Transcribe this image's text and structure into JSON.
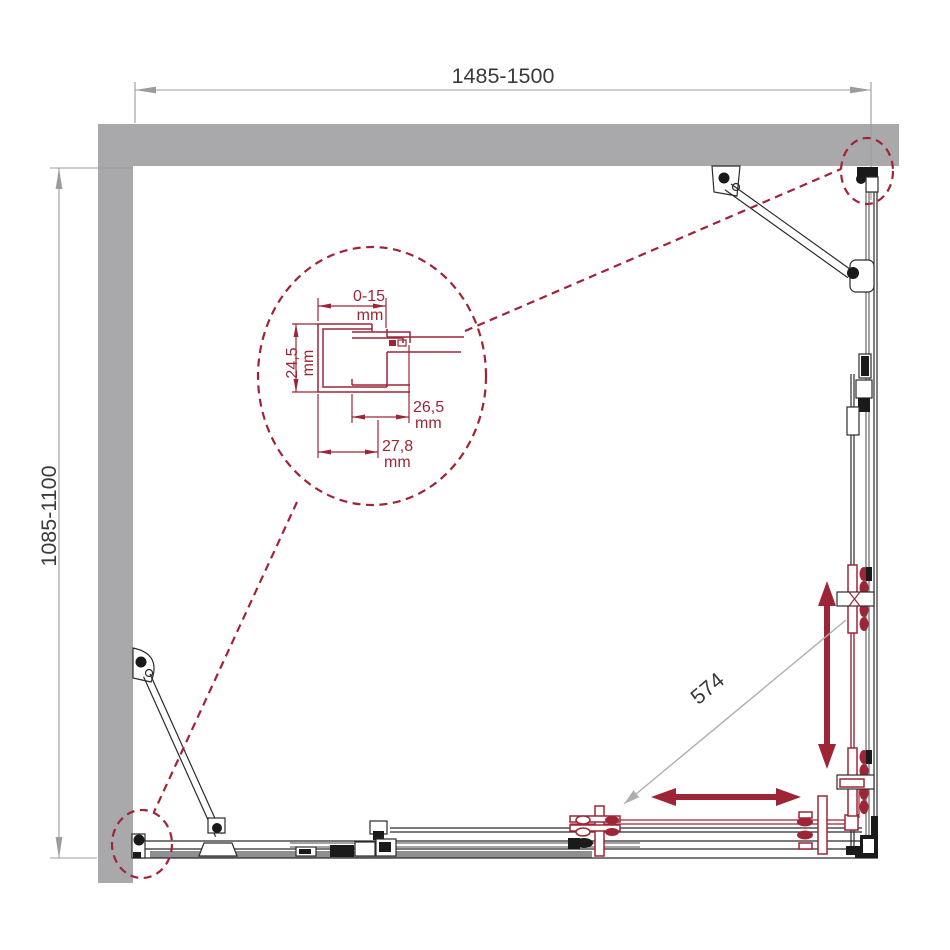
{
  "drawing": {
    "kind": "shower-enclosure-top-view-technical-drawing",
    "dimensions": {
      "overall_width_label": "1485-1500",
      "overall_depth_label": "1085-1100",
      "door_opening_label": "574"
    },
    "detail_dims": {
      "gap": {
        "value": "0-15",
        "unit": "mm"
      },
      "depth": {
        "value": "24,5",
        "unit": "mm"
      },
      "inner": {
        "value": "26,5",
        "unit": "mm"
      },
      "outer": {
        "value": "27,8",
        "unit": "mm"
      }
    },
    "colors": {
      "wall_gray": "#a9a9ac",
      "rail_gray": "#8f8f92",
      "line_black": "#2b2b2b",
      "accent_red": "#9e2536",
      "dashed_red": "#a12338",
      "dim_line_gray": "#9c9ca0",
      "text_dark": "#3a3a3a"
    }
  }
}
